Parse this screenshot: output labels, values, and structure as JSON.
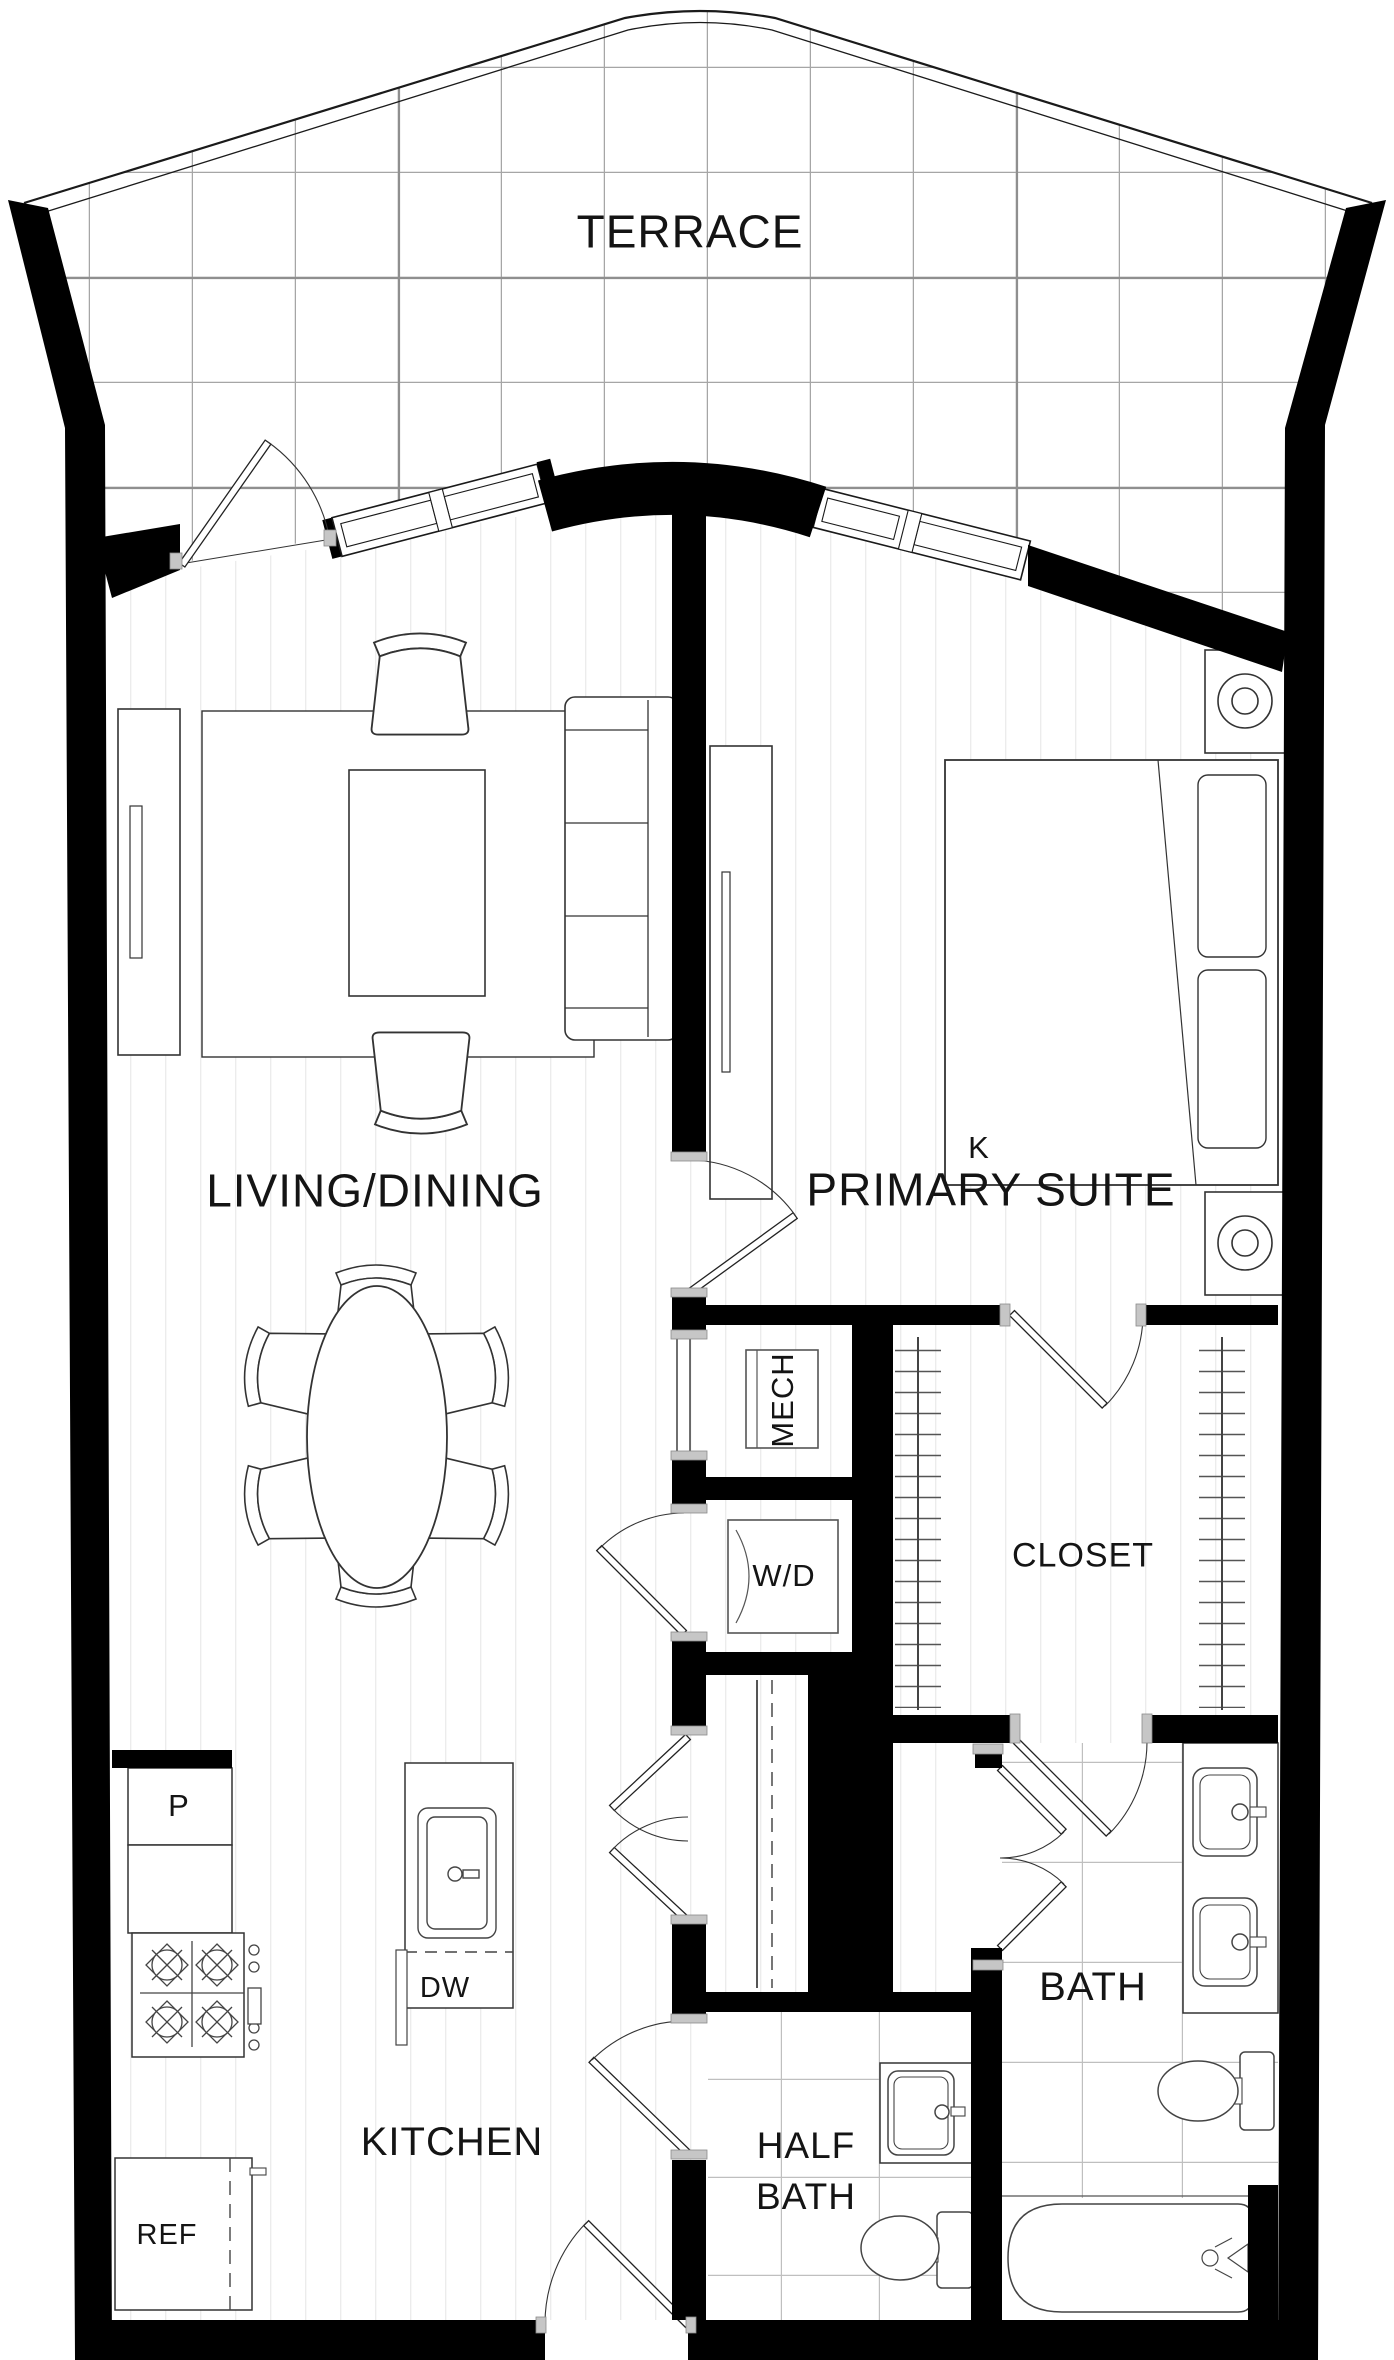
{
  "labels": {
    "terrace": "TERRACE",
    "living_dining": "LIVING/DINING",
    "primary_suite": "PRIMARY SUITE",
    "bed_size": "K",
    "mech": "MECH",
    "washer_dryer": "W/D",
    "closet": "CLOSET",
    "pantry": "P",
    "dishwasher": "DW",
    "kitchen": "KITCHEN",
    "refrigerator": "REF",
    "half_bath": "HALF BATH",
    "bath": "BATH"
  },
  "colors": {
    "wall": "#000000",
    "furniture_line": "#333333",
    "floorboard_line": "#ececec",
    "tile_line": "#bfbfbf",
    "terrace_grid": "#a6a6a6",
    "door_frame_cap": "#c6c6c6",
    "text": "#141414"
  }
}
